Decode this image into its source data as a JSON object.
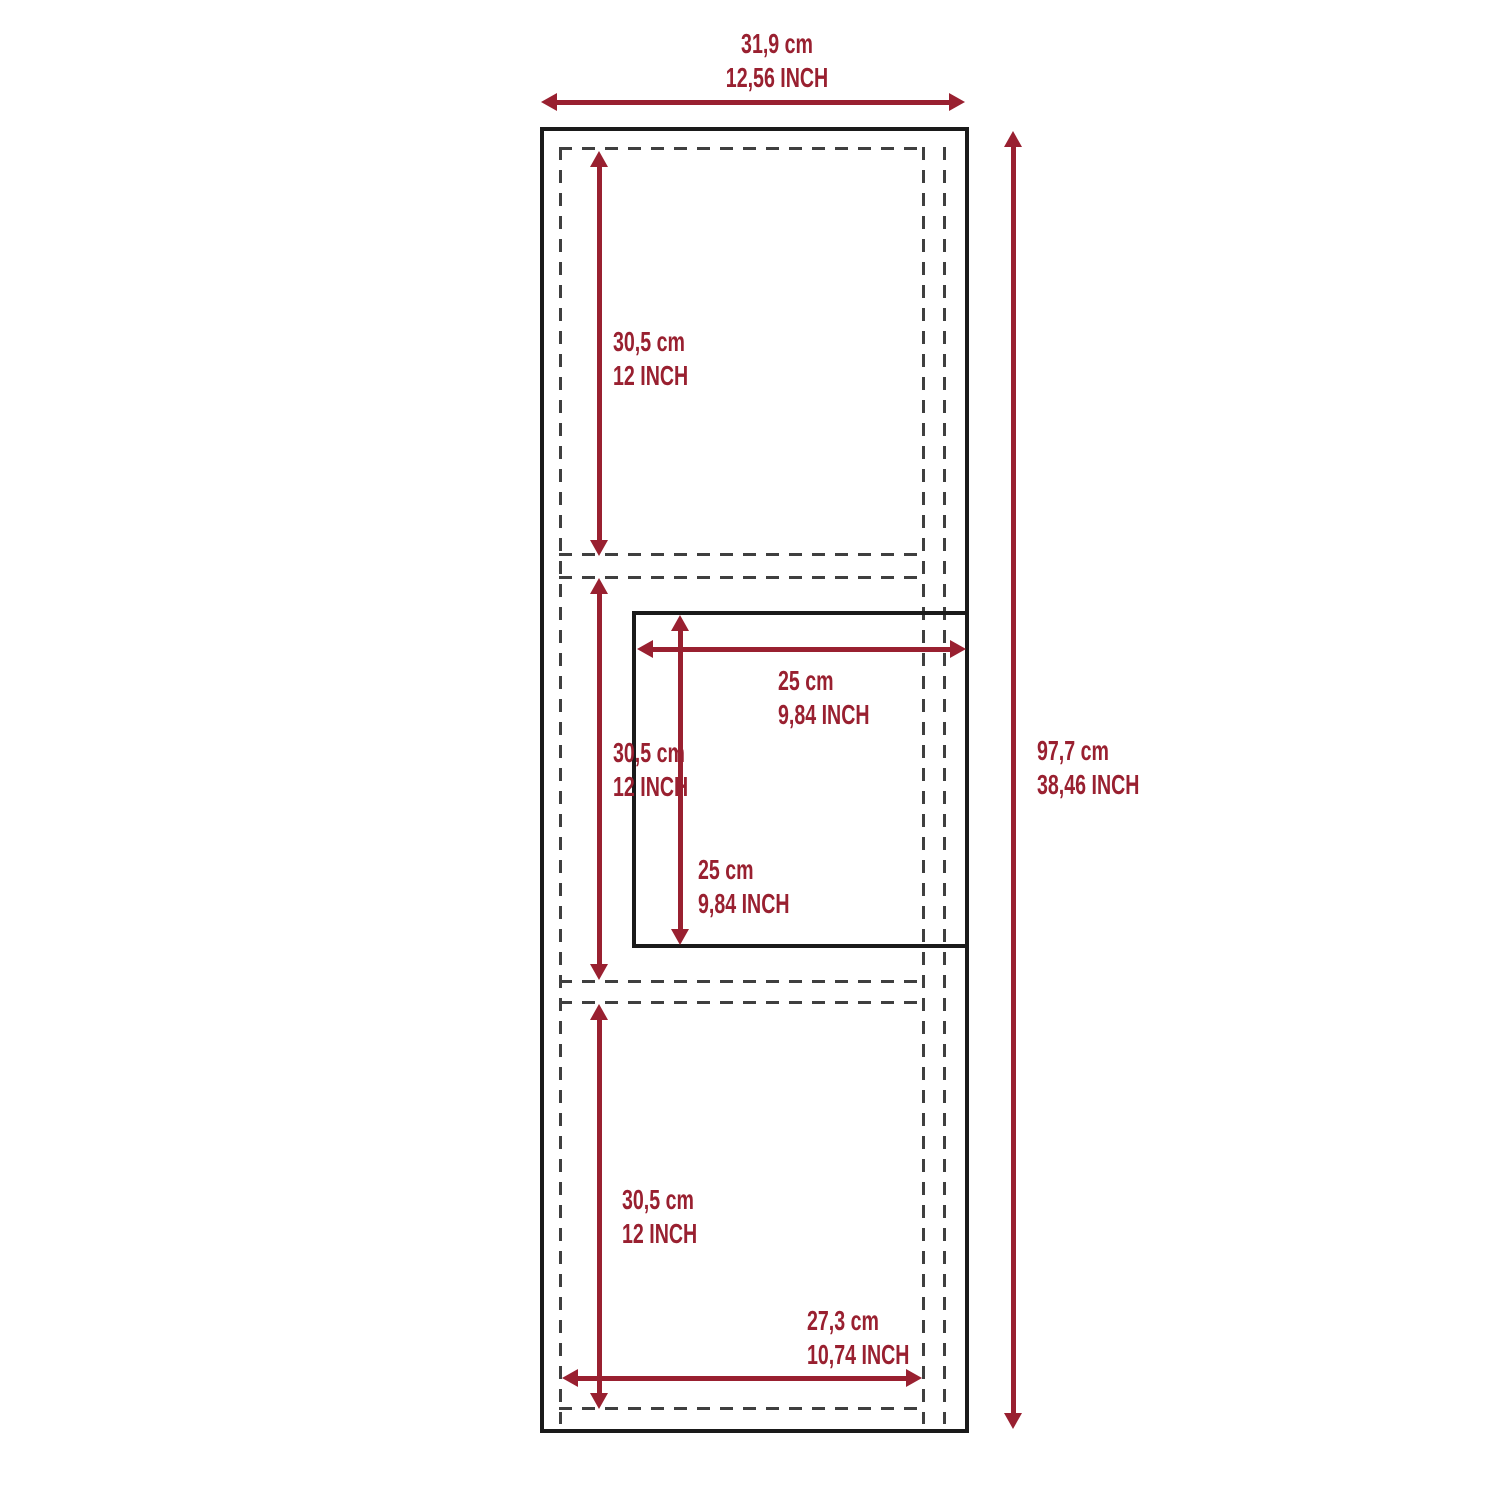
{
  "diagram_title": "Cabinet dimension diagram",
  "colors": {
    "dimension_red": "#992030",
    "outline_black": "#1a1a1a",
    "dashed_gray": "#3f3f3f",
    "background": "#ffffff"
  },
  "dimensions": {
    "overall_width": {
      "cm": "31,9 cm",
      "inch": "12,56 INCH"
    },
    "overall_height": {
      "cm": "97,7 cm",
      "inch": "38,46 INCH"
    },
    "top_section_height": {
      "cm": "30,5 cm",
      "inch": "12 INCH"
    },
    "middle_section_height": {
      "cm": "30,5 cm",
      "inch": "12 INCH"
    },
    "bottom_section_height": {
      "cm": "30,5 cm",
      "inch": "12 INCH"
    },
    "opening_width": {
      "cm": "25 cm",
      "inch": "9,84 INCH"
    },
    "opening_height": {
      "cm": "25 cm",
      "inch": "9,84 INCH"
    },
    "interior_width": {
      "cm": "27,3 cm",
      "inch": "10,74 INCH"
    }
  }
}
